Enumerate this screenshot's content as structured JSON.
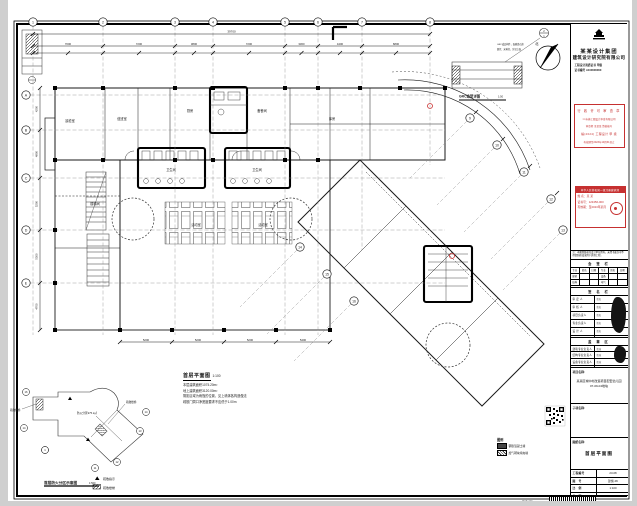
{
  "sheet": {
    "plan_title": "首层平面图",
    "plan_scale": "1:100",
    "notes": [
      "本层建筑面积1075.20m²",
      "地上建筑面积3120.00m²",
      "阴影区域为雨篷的位置，见上墙体各构造做法",
      "疏散门洞口净宽度要求不应低于1.00m"
    ],
    "north_label": "北",
    "grc": {
      "title": "GRC造型详图",
      "scale": "1:50",
      "tag_top": "2",
      "tag_bot": "1",
      "note1": "GRC成品构件，面刷真石漆",
      "note2": "颜色：米黄色，详见立面"
    },
    "keyplan": {
      "title": "首层防火分区示意图",
      "scale": "1:500",
      "area": "防火分区975.2㎡",
      "stair_left": "疏散楼梯",
      "stair_right": "疏散楼梯",
      "legend1": "疏散指示",
      "legend2": "疏散楼梯"
    },
    "plan_legend": {
      "title": "图例",
      "item1": "钢筋混凝土墙",
      "item2": "加气砌块填充墙"
    },
    "barcode_label": "图纸编码"
  },
  "plan": {
    "grid_top": [
      {
        "x": 33,
        "label": "1"
      },
      {
        "x": 103,
        "label": "2"
      },
      {
        "x": 175,
        "label": "3"
      },
      {
        "x": 213,
        "label": "4"
      },
      {
        "x": 285,
        "label": "5"
      },
      {
        "x": 318,
        "label": "6"
      },
      {
        "x": 362,
        "label": "7",
        "y2": 250
      },
      {
        "x": 430,
        "label": "8",
        "y2": 165
      }
    ],
    "grid_left": [
      {
        "y": 95,
        "label": "A"
      },
      {
        "y": 130,
        "label": "B"
      },
      {
        "y": 178,
        "label": "C"
      },
      {
        "y": 230,
        "label": "D"
      },
      {
        "y": 283,
        "label": "E"
      }
    ],
    "grid_diag": [
      {
        "x": 470,
        "y": 118,
        "label": "9"
      },
      {
        "x": 497,
        "y": 145,
        "label": "10"
      },
      {
        "x": 524,
        "y": 172,
        "label": "11"
      },
      {
        "x": 551,
        "y": 199,
        "label": "12"
      },
      {
        "x": 563,
        "y": 230,
        "label": "13"
      },
      {
        "x": 300,
        "y": 247,
        "label": "14"
      },
      {
        "x": 327,
        "y": 274,
        "label": "15"
      },
      {
        "x": 354,
        "y": 301,
        "label": "16"
      }
    ],
    "dims": {
      "overall": "39700",
      "top": [
        "7000",
        "7200",
        "3800",
        "7200",
        "3300",
        "4400",
        "6800"
      ],
      "left": [
        "4200",
        "4800",
        "5200",
        "5300",
        "4700"
      ],
      "bottom": [
        "5200",
        "5200",
        "5200",
        "5400"
      ]
    },
    "keyplan_bubbles": [
      {
        "x": 26,
        "y": 392,
        "label": "16"
      },
      {
        "x": 24,
        "y": 428,
        "label": "14"
      },
      {
        "x": 45,
        "y": 450,
        "label": "1"
      },
      {
        "x": 95,
        "y": 468,
        "label": "11"
      },
      {
        "x": 117,
        "y": 462,
        "label": "12"
      },
      {
        "x": 140,
        "y": 431,
        "label": "13"
      },
      {
        "x": 146,
        "y": 412,
        "label": "14"
      }
    ],
    "room_labels": [
      {
        "x": 70,
        "y": 122,
        "t": "晨检室"
      },
      {
        "x": 122,
        "y": 120,
        "t": "值班室"
      },
      {
        "x": 190,
        "y": 112,
        "t": "厨房"
      },
      {
        "x": 262,
        "y": 112,
        "t": "备餐间"
      },
      {
        "x": 332,
        "y": 120,
        "t": "库房"
      },
      {
        "x": 171,
        "y": 171,
        "t": "卫生间"
      },
      {
        "x": 257,
        "y": 171,
        "t": "卫生间"
      },
      {
        "x": 196,
        "y": 226,
        "t": "活动室"
      },
      {
        "x": 263,
        "y": 226,
        "t": "活动室"
      },
      {
        "x": 95,
        "y": 205,
        "t": "楼梯间"
      }
    ],
    "columns": [
      [
        55,
        88
      ],
      [
        103,
        88
      ],
      [
        175,
        88
      ],
      [
        213,
        88
      ],
      [
        285,
        88
      ],
      [
        318,
        88
      ],
      [
        360,
        88
      ],
      [
        400,
        88
      ],
      [
        445,
        88
      ],
      [
        55,
        160
      ],
      [
        103,
        160
      ],
      [
        175,
        160
      ],
      [
        213,
        160
      ],
      [
        285,
        160
      ],
      [
        318,
        160
      ],
      [
        120,
        330
      ],
      [
        172,
        330
      ],
      [
        224,
        330
      ],
      [
        276,
        330
      ],
      [
        330,
        330
      ],
      [
        55,
        230
      ],
      [
        55,
        283
      ],
      [
        55,
        330
      ]
    ]
  },
  "titleblock": {
    "company": {
      "line1": "某某设计集团",
      "line2": "建筑设计研究院有限公司",
      "addr1": "工程设计资质证书 甲级",
      "addr2": "证书编号 A100000000"
    },
    "stamp1": {
      "l1": "行 政 许 可 审 查 章",
      "l2": "××市施工图设计审查有限公司",
      "l3": "审查师 王某某 资格编号",
      "l4": "编(2024) 工程设计 甲 级",
      "l5": "有效期至2023年10月31日止"
    },
    "stamp2": {
      "header": "中华人民共和国一级注册建筑师",
      "l1": "姓 名：某 某",
      "l2": "证书号：123456-000",
      "l3": "有效期：至2023年某月"
    },
    "note": "注：本图纸版权归设计单位所有，未经书面许可不得复制修改或用于其他工程。",
    "huiqian": {
      "title": "会 签 栏",
      "cols": [
        "专业",
        "姓名",
        "日期",
        "专业",
        "姓名",
        "日期"
      ],
      "rows": [
        [
          "建筑",
          "",
          "",
          "设备",
          "",
          ""
        ],
        [
          "结构",
          "",
          "",
          "电气",
          "",
          ""
        ]
      ]
    },
    "sign": {
      "title": "签 名 栏",
      "rows": [
        [
          "审 定 人",
          "签名"
        ],
        [
          "审 核 人",
          "签名"
        ],
        [
          "项目负责人",
          "签名"
        ],
        [
          "专业负责人",
          "签名"
        ],
        [
          "设 计 人",
          "签名"
        ],
        [
          "校 对 人",
          "签名"
        ]
      ]
    },
    "seal": {
      "title": "盖 章 区",
      "rows": [
        [
          "建筑专业负责人",
          "签章"
        ],
        [
          "结构专业负责人",
          "签章"
        ],
        [
          "设备专业负责人",
          "签章"
        ],
        [
          "电气专业负责人",
          "签章"
        ]
      ]
    },
    "project_label": "项目名称:",
    "project_line1": "某某区城中村改造项目配套幼儿园",
    "project_line2": "07-09-04地块",
    "subitem_label": "子项名称:",
    "drawing_label": "图纸名称:",
    "drawing_value": "首层平面图",
    "info_rows": [
      [
        "工程编号",
        "23-08"
      ],
      [
        "图　号",
        "建施-06"
      ],
      [
        "比　例",
        "1:100"
      ],
      [
        "日　期",
        "2022.01.10"
      ]
    ]
  }
}
